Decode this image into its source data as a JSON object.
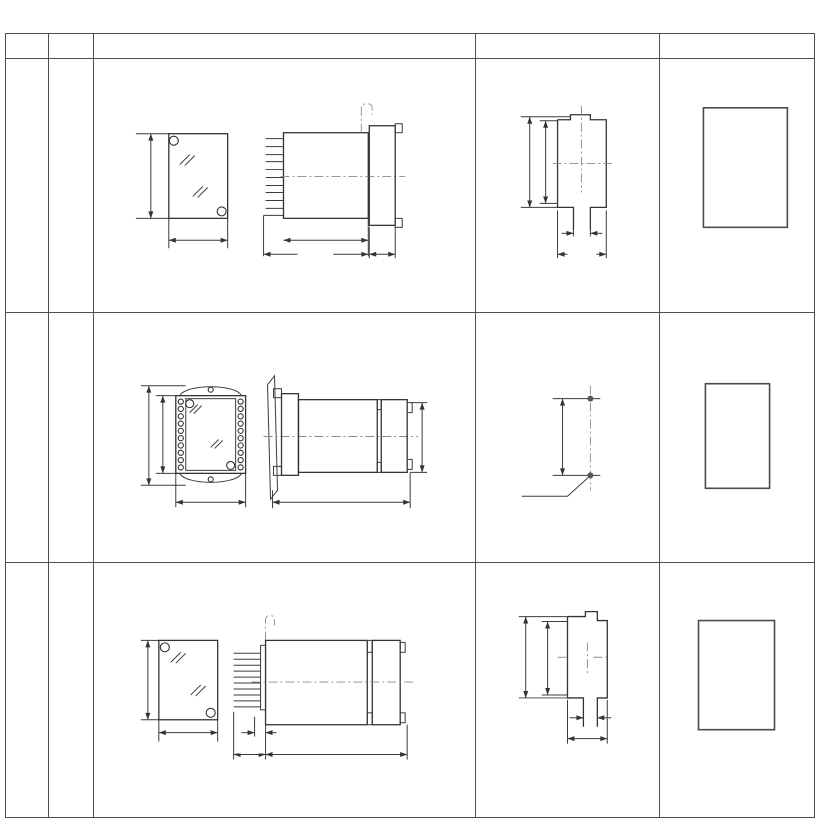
{
  "unit_label": "单位：mm",
  "header": {
    "fig": "图号",
    "structure": "结构",
    "outline": "外 形 尺 寸 图",
    "mounting": "安装开孔尺寸图",
    "terminal": "端子图"
  },
  "rows": [
    {
      "fig_no": "附图3",
      "structure": {
        "model": "CJ-1",
        "desc": "嵌入式后接线",
        "code": "A11K"
      },
      "outline": {
        "front_h": "115",
        "front_w": "72",
        "body_len": "100.5",
        "total_len": "122.5",
        "flange_t": "35"
      },
      "mounting": {
        "outer_h": "107.5",
        "inner_h": "105",
        "slot_w": "16",
        "cutout_w": "[64]"
      },
      "terminal": {
        "view": "(背视)",
        "inner_left": [
          "10",
          "12",
          "14",
          "16",
          "18",
          "20"
        ],
        "inner_right": [
          "9",
          "11",
          "13",
          "15",
          "17",
          "19"
        ],
        "outer_left": [
          "2",
          "4",
          "6",
          "8"
        ],
        "outer_right": [
          "1",
          "3",
          "5",
          "7"
        ]
      }
    },
    {
      "fig_no": "附图3",
      "structure": {
        "model": "CJ-1",
        "desc": "板前接线",
        "code": "A11Q"
      },
      "outline": {
        "front_h_outer": "149",
        "front_h_inner": "125",
        "front_w": "105",
        "side_len": "156",
        "side_h": "115"
      },
      "mounting": {
        "hole_pitch": "133",
        "hole_note": "2-φ5"
      },
      "terminal": {
        "view": "(前 视)",
        "rows": [
          [
            "1",
            "2"
          ],
          [
            "3",
            "4"
          ],
          [
            "5",
            "6"
          ],
          [
            "7",
            "8"
          ],
          [
            "9",
            "10"
          ],
          [
            "11",
            "12"
          ],
          [
            "13",
            "13"
          ],
          [
            "15",
            "16"
          ],
          [
            "17",
            "18"
          ],
          [
            "19",
            "20"
          ]
        ]
      }
    },
    {
      "fig_no": "附图3",
      "structure": {
        "model": "CJ-1",
        "desc": "凸出式板后接线",
        "code": "A11H"
      },
      "outline": {
        "front_h": "115",
        "front_w": "72",
        "pin_len": "31.5",
        "strip_d": "9.5",
        "body_len": "126"
      },
      "mounting": {
        "outer_h": "107.5",
        "inner_h": "104",
        "slot_w": "16",
        "cutout_w": "64"
      },
      "terminal": {
        "view": "(背 视)",
        "inner_left": [
          "10",
          "12",
          "14",
          "16",
          "18",
          "20"
        ],
        "inner_right": [
          "9",
          "11",
          "13",
          "15",
          "17",
          "19"
        ],
        "outer_left": [
          "2",
          "4",
          "6",
          "8"
        ],
        "outer_right": [
          "1",
          "3",
          "5",
          "7"
        ]
      }
    }
  ]
}
